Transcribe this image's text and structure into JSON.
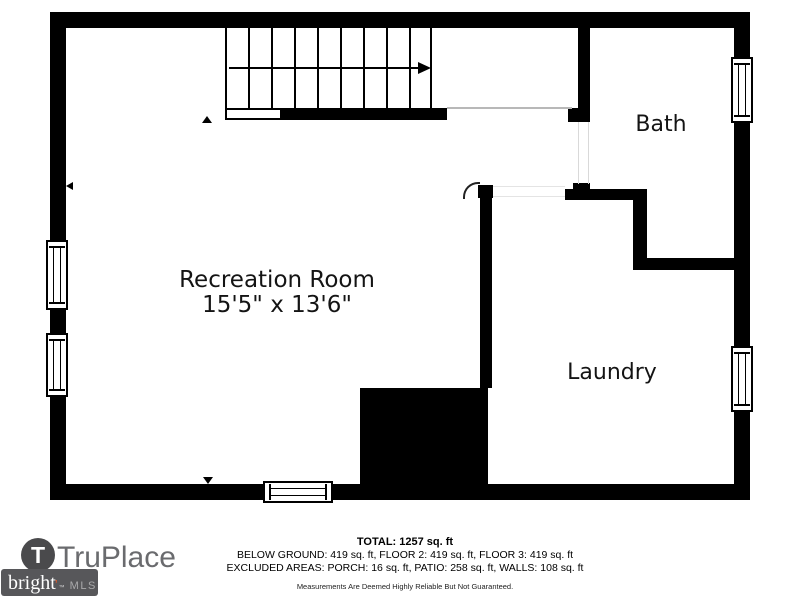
{
  "plan": {
    "walls": [
      {
        "name": "outer-top-wall",
        "x": 50,
        "y": 12,
        "w": 700,
        "h": 16
      },
      {
        "name": "outer-left-wall-upper",
        "x": 50,
        "y": 12,
        "w": 16,
        "h": 228
      },
      {
        "name": "outer-left-wall-mid",
        "x": 50,
        "y": 310,
        "w": 16,
        "h": 23
      },
      {
        "name": "outer-left-wall-lower",
        "x": 50,
        "y": 397,
        "w": 16,
        "h": 103
      },
      {
        "name": "outer-right-wall-upper",
        "x": 734,
        "y": 12,
        "w": 16,
        "h": 45
      },
      {
        "name": "outer-right-wall-mid",
        "x": 734,
        "y": 123,
        "w": 16,
        "h": 223
      },
      {
        "name": "outer-right-wall-lower",
        "x": 734,
        "y": 412,
        "w": 16,
        "h": 88
      },
      {
        "name": "outer-bottom-wall-left",
        "x": 50,
        "y": 484,
        "w": 213,
        "h": 16
      },
      {
        "name": "outer-bottom-wall-right",
        "x": 333,
        "y": 484,
        "w": 417,
        "h": 16
      },
      {
        "name": "stair-base-wall",
        "x": 282,
        "y": 108,
        "w": 165,
        "h": 12
      },
      {
        "name": "bath-west-wall",
        "x": 578,
        "y": 28,
        "w": 12,
        "h": 80
      },
      {
        "name": "bath-west-wall-notch",
        "x": 568,
        "y": 108,
        "w": 22,
        "h": 14
      },
      {
        "name": "bath-door-jamb",
        "x": 573,
        "y": 183,
        "w": 17,
        "h": 7
      },
      {
        "name": "hall-south-wall",
        "x": 565,
        "y": 189,
        "w": 82,
        "h": 11
      },
      {
        "name": "hall-east-wall",
        "x": 633,
        "y": 197,
        "w": 14,
        "h": 73
      },
      {
        "name": "laundry-north-wall",
        "x": 647,
        "y": 258,
        "w": 87,
        "h": 12
      },
      {
        "name": "laundry-door-post",
        "x": 478,
        "y": 185,
        "w": 15,
        "h": 13
      },
      {
        "name": "laundry-west-wall",
        "x": 480,
        "y": 198,
        "w": 12,
        "h": 190
      },
      {
        "name": "utility-block",
        "x": 360,
        "y": 388,
        "w": 128,
        "h": 96
      }
    ],
    "lines": [
      {
        "name": "stairwell-edge-line",
        "x": 447,
        "y": 107,
        "w": 125,
        "h": 2,
        "color": "#b8b8b8"
      },
      {
        "name": "bath-door-opening-left-line",
        "x": 578,
        "y": 122,
        "w": 1,
        "h": 62,
        "color": "#d9d9d9"
      },
      {
        "name": "bath-door-opening-right-line",
        "x": 588,
        "y": 122,
        "w": 1,
        "h": 62,
        "color": "#d9d9d9"
      },
      {
        "name": "hall-door-opening-top-line",
        "x": 493,
        "y": 186,
        "w": 72,
        "h": 1,
        "color": "#e4e4e4"
      },
      {
        "name": "hall-door-opening-bottom-line",
        "x": 493,
        "y": 196,
        "w": 72,
        "h": 1,
        "color": "#e4e4e4"
      }
    ],
    "windows": [
      {
        "name": "left-window-upper",
        "x": 46,
        "y": 240,
        "w": 22,
        "h": 70,
        "o": "v"
      },
      {
        "name": "left-window-lower",
        "x": 46,
        "y": 333,
        "w": 22,
        "h": 64,
        "o": "v"
      },
      {
        "name": "bath-window",
        "x": 731,
        "y": 57,
        "w": 22,
        "h": 66,
        "o": "v"
      },
      {
        "name": "laundry-window",
        "x": 731,
        "y": 346,
        "w": 22,
        "h": 66,
        "o": "v"
      },
      {
        "name": "bottom-window",
        "x": 263,
        "y": 481,
        "w": 70,
        "h": 22,
        "o": "h"
      }
    ],
    "stairs": {
      "x": 225,
      "y": 28,
      "w": 207,
      "h": 80,
      "treadLines": 10,
      "landing": {
        "x": 225,
        "y": 108,
        "w": 57,
        "h": 12
      },
      "arrow": {
        "x1": 229,
        "y": 67,
        "x2": 418
      }
    },
    "doorArc": {
      "x": 463,
      "y": 182,
      "r": 15
    },
    "markers": [
      {
        "name": "left-wall-marker",
        "type": "left",
        "x": 66,
        "y": 182
      },
      {
        "name": "stair-marker",
        "type": "up",
        "x": 202,
        "y": 116
      },
      {
        "name": "bottom-wall-marker",
        "type": "down",
        "x": 203,
        "y": 477
      }
    ],
    "labels": [
      {
        "name": "recreation-room",
        "lines": [
          "Recreation Room",
          "15'5\" x 13'6\""
        ],
        "x": 147,
        "y": 268,
        "w": 260,
        "fs": 23
      },
      {
        "name": "bath",
        "lines": [
          "Bath"
        ],
        "x": 611,
        "y": 112,
        "w": 100,
        "fs": 22
      },
      {
        "name": "laundry",
        "lines": [
          "Laundry"
        ],
        "x": 542,
        "y": 360,
        "w": 140,
        "fs": 22
      }
    ]
  },
  "footer": {
    "summary": {
      "total": "TOTAL: 1257 sq. ft",
      "floors": "BELOW GROUND: 419 sq. ft, FLOOR 2: 419 sq. ft, FLOOR 3: 419 sq. ft",
      "excluded": "EXCLUDED AREAS: PORCH: 16 sq. ft, PATIO: 258 sq. ft, WALLS: 108 sq. ft",
      "disclaimer": "Measurements Are Deemed Highly Reliable But Not Guaranteed."
    },
    "truplace": {
      "initial": "T",
      "wordmark": "TruPlace"
    },
    "brightmls": {
      "word": "bright",
      "accent": "’",
      "tm": "™",
      "suffix": "MLS"
    }
  },
  "colors": {
    "wall": "#000000",
    "logo_circle": "#4a4a4c",
    "logo_text": "#6a6b6e",
    "bright_box": "#57575a",
    "bright_accent": "#e0592a"
  }
}
